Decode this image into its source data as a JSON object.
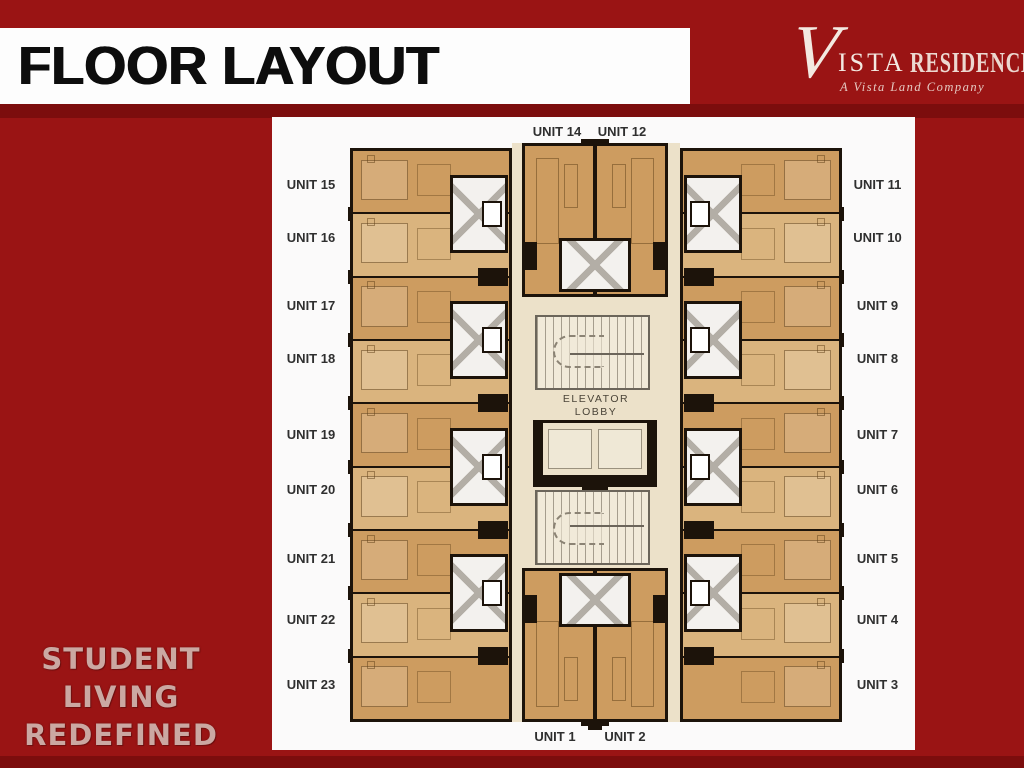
{
  "slide": {
    "title": "FLOOR LAYOUT",
    "brand": {
      "v": "V",
      "vista": "ISTA",
      "residences": "RESIDENCES",
      "tagline": "A Vista Land Company"
    },
    "motto": {
      "line1": "STUDENT",
      "line2": "LIVING",
      "line3": "REDEFINED"
    }
  },
  "floor_plan": {
    "top_labels": {
      "unit14": "UNIT 14",
      "unit12": "UNIT 12"
    },
    "bottom_labels": {
      "unit1": "UNIT 1",
      "unit2": "UNIT 2"
    },
    "left_labels": [
      "UNIT 15",
      "UNIT 16",
      "UNIT 17",
      "UNIT 18",
      "UNIT 19",
      "UNIT 20",
      "UNIT 21",
      "UNIT 22",
      "UNIT 23"
    ],
    "right_labels": [
      "UNIT 11",
      "UNIT 10",
      "UNIT 9",
      "UNIT 8",
      "UNIT 7",
      "UNIT 6",
      "UNIT 5",
      "UNIT 4",
      "UNIT 3"
    ],
    "core": {
      "elevator_line1": "ELEVATOR",
      "elevator_line2": "LOBBY"
    }
  },
  "colors": {
    "background_red": "#9a1414",
    "dark_red_band": "#7c0d0d",
    "header_band": "#fdfdfd",
    "header_text": "#0d0d0d",
    "plan_panel": "#fbfafa",
    "corridor": "#ece1c9",
    "unit_fill_dark": "#cd9c60",
    "unit_fill_light": "#dab47e",
    "wall": "#1c130a",
    "bathroom_pod": "#f3f1ee",
    "unit_label_text": "#2f2f2f",
    "logo_text": "#f3e9e1",
    "motto_text": "#cba8a2"
  }
}
